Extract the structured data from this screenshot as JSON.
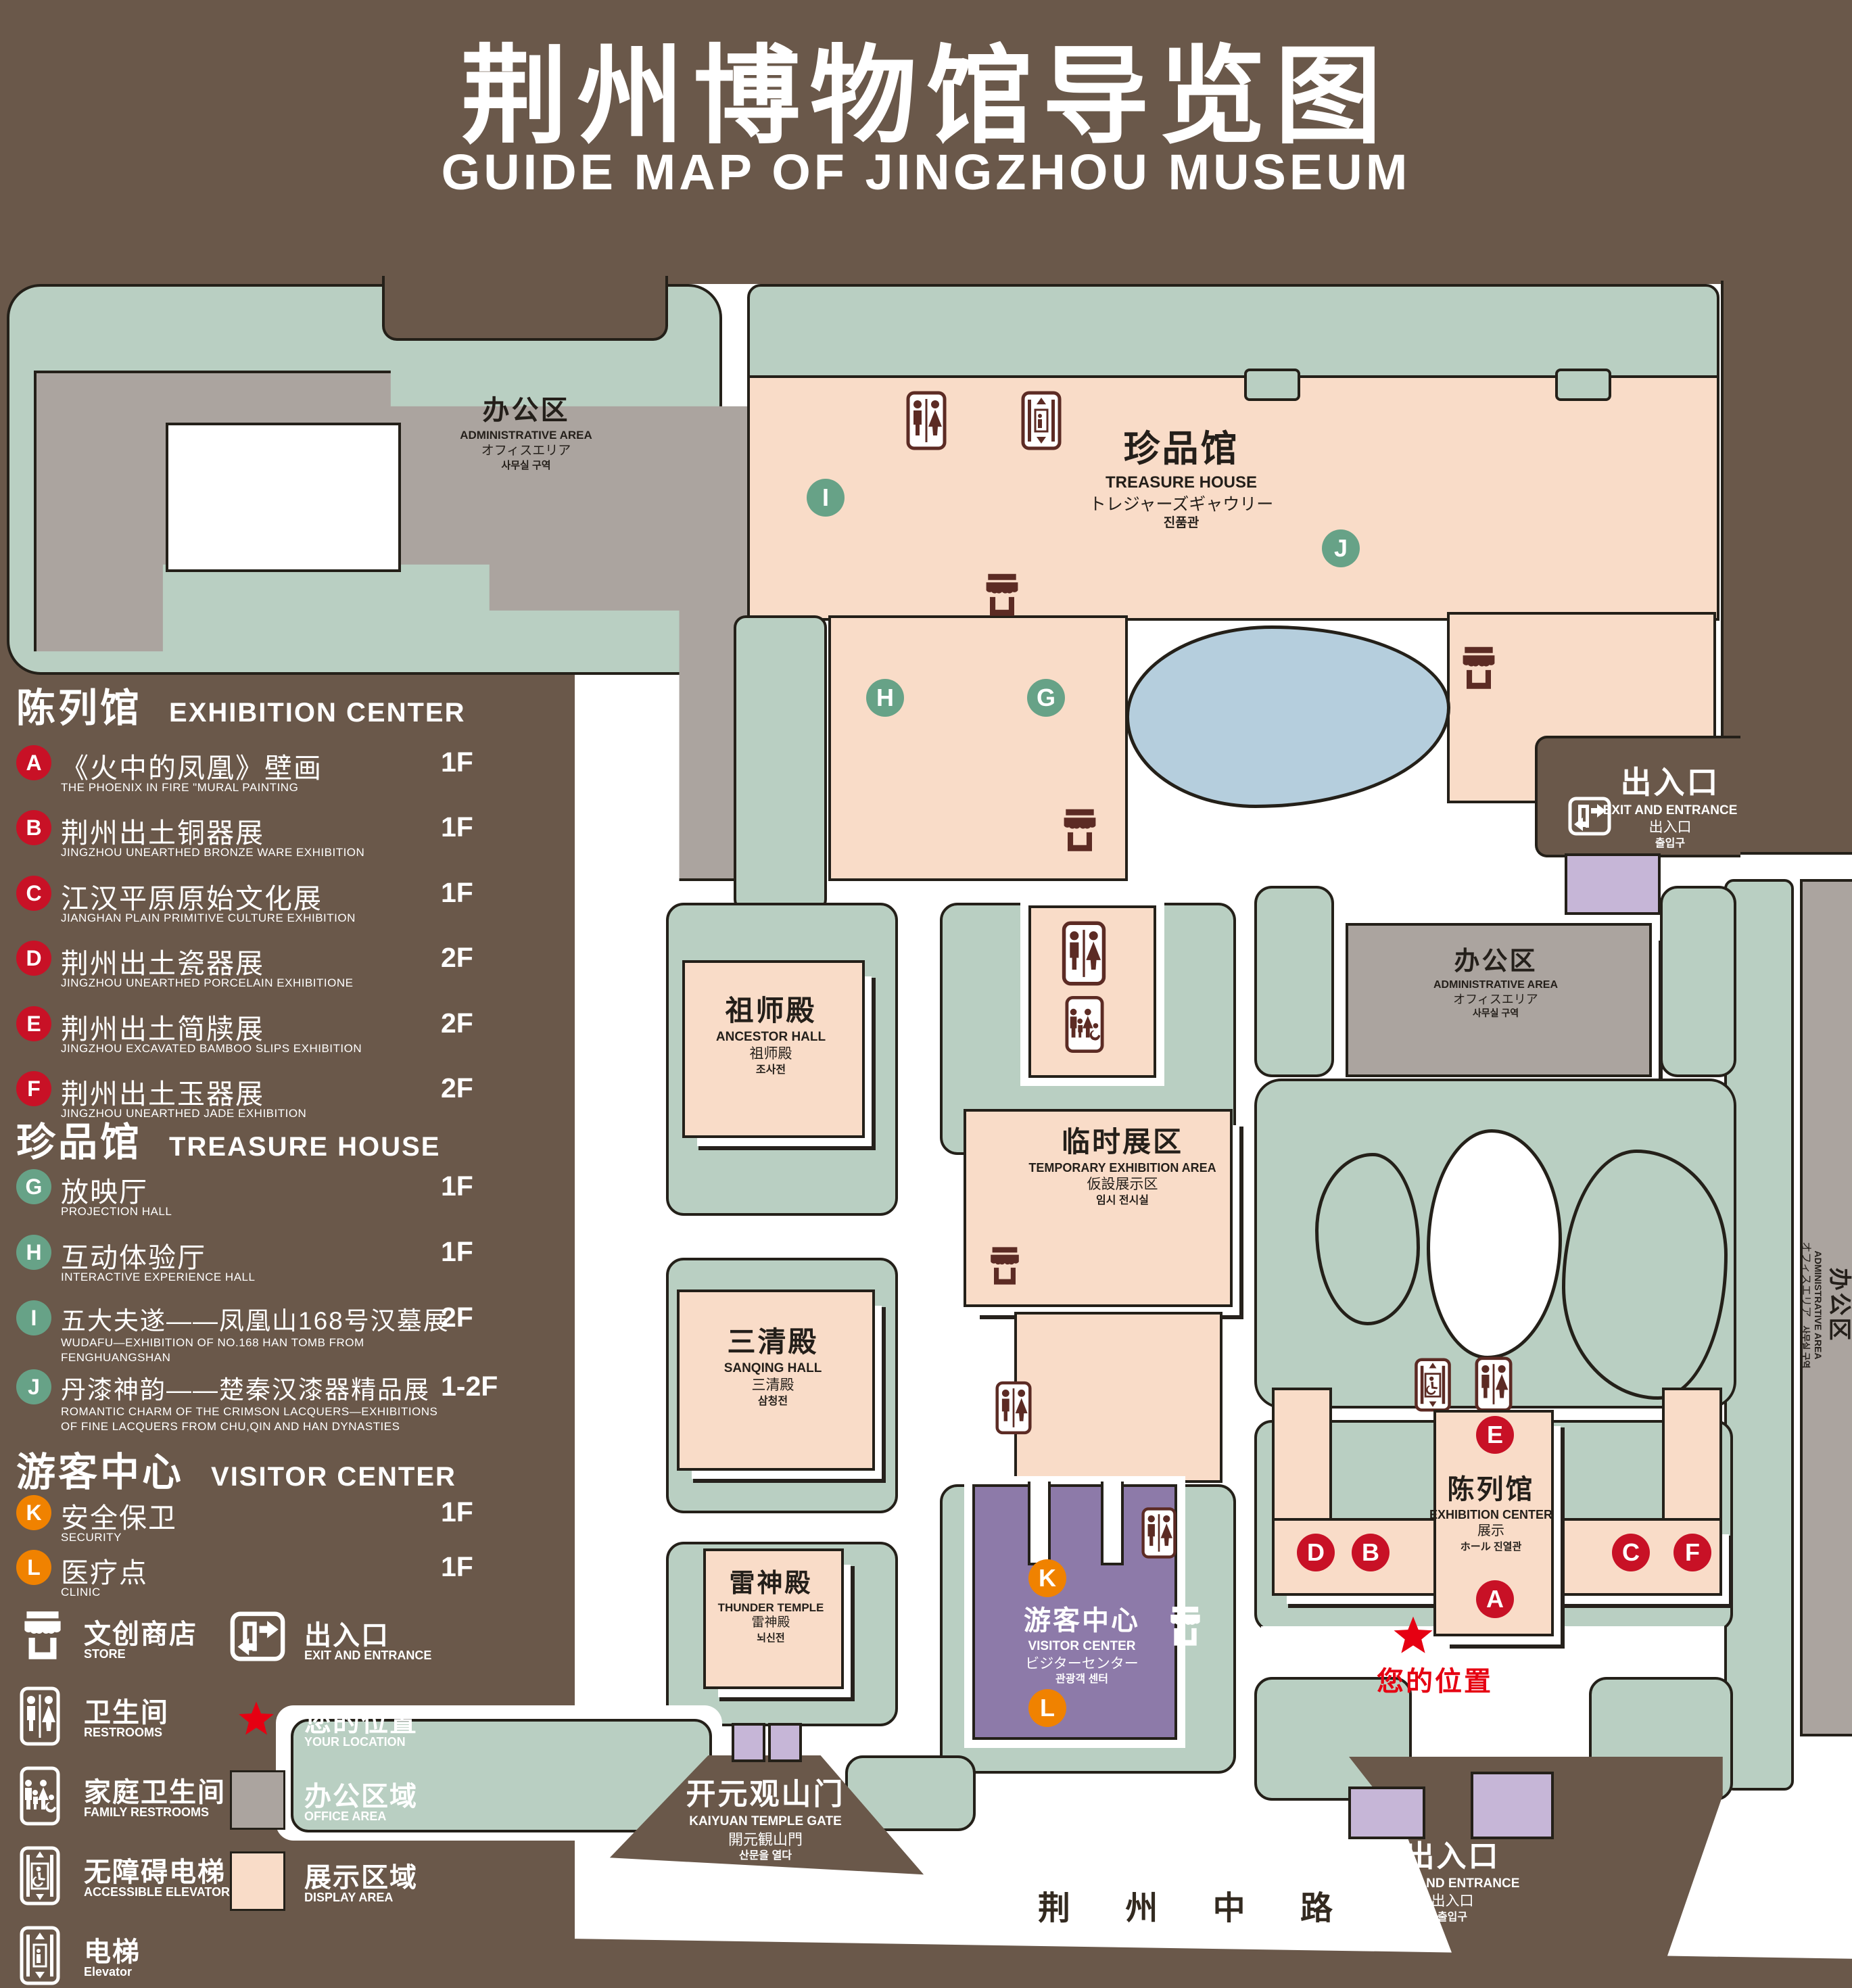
{
  "title": {
    "cn": "荆州博物馆导览图",
    "en": "GUIDE MAP OF JINGZHOU MUSEUM"
  },
  "legend": {
    "sections": [
      {
        "cn": "陈列馆",
        "en": "EXHIBITION CENTER",
        "items": [
          {
            "letter": "A",
            "cn": "《火中的凤凰》壁画",
            "en": "THE PHOENIX IN FIRE \"MURAL PAINTING",
            "floor": "1F"
          },
          {
            "letter": "B",
            "cn": "荆州出土铜器展",
            "en": "JINGZHOU UNEARTHED BRONZE WARE EXHIBITION",
            "floor": "1F"
          },
          {
            "letter": "C",
            "cn": "江汉平原原始文化展",
            "en": "JIANGHAN PLAIN PRIMITIVE CULTURE EXHIBITION",
            "floor": "1F"
          },
          {
            "letter": "D",
            "cn": "荆州出土瓷器展",
            "en": "JINGZHOU UNEARTHED PORCELAIN EXHIBITIONE",
            "floor": "2F"
          },
          {
            "letter": "E",
            "cn": "荆州出土简牍展",
            "en": "JINGZHOU EXCAVATED BAMBOO SLIPS EXHIBITION",
            "floor": "2F"
          },
          {
            "letter": "F",
            "cn": "荆州出土玉器展",
            "en": "JINGZHOU UNEARTHED JADE EXHIBITION",
            "floor": "2F"
          }
        ]
      },
      {
        "cn": "珍品馆",
        "en": "TREASURE HOUSE",
        "items": [
          {
            "letter": "G",
            "cn": "放映厅",
            "en": "PROJECTION HALL",
            "floor": "1F"
          },
          {
            "letter": "H",
            "cn": "互动体验厅",
            "en": "INTERACTIVE EXPERIENCE HALL",
            "floor": "1F"
          },
          {
            "letter": "I",
            "cn": "五大夫遂——凤凰山168号汉墓展",
            "en": "WUDAFU—EXHIBITION OF NO.168 HAN TOMB FROM FENGHUANGSHAN",
            "floor": "2F"
          },
          {
            "letter": "J",
            "cn": "丹漆神韵——楚秦汉漆器精品展",
            "en": "ROMANTIC CHARM OF THE CRIMSON LACQUERS—EXHIBITIONS OF FINE LACQUERS FROM CHU,QIN AND HAN DYNASTIES",
            "floor": "1-2F"
          }
        ]
      },
      {
        "cn": "游客中心",
        "en": "VISITOR CENTER",
        "items": [
          {
            "letter": "K",
            "cn": "安全保卫",
            "en": "SECURITY",
            "floor": "1F"
          },
          {
            "letter": "L",
            "cn": "医疗点",
            "en": "CLINIC",
            "floor": "1F"
          }
        ]
      }
    ],
    "symbols": {
      "store": {
        "cn": "文创商店",
        "en": "STORE"
      },
      "restrooms": {
        "cn": "卫生间",
        "en": "RESTROOMS"
      },
      "family_restrooms": {
        "cn": "家庭卫生间",
        "en": "FAMILY RESTROOMS"
      },
      "accessible_elevator": {
        "cn": "无障碍电梯",
        "en": "ACCESSIBLE ELEVATOR"
      },
      "elevator": {
        "cn": "电梯",
        "en": "Elevator"
      },
      "exit": {
        "cn": "出入口",
        "en": "EXIT AND ENTRANCE"
      },
      "your_location": {
        "cn": "您的位置",
        "en": "YOUR LOCATION"
      },
      "office_area": {
        "cn": "办公区域",
        "en": "OFFICE AREA"
      },
      "display_area": {
        "cn": "展示区域",
        "en": "DISPLAY AREA"
      }
    }
  },
  "map": {
    "buildings": {
      "admin_tl": {
        "cn": "办公区",
        "en": "ADMINISTRATIVE AREA",
        "jp": "オフィスエリア",
        "kr": "사무실 구역"
      },
      "treasure_house": {
        "cn": "珍品馆",
        "en": "TREASURE HOUSE",
        "jp": "トレジャーズギャウリー",
        "kr": "진품관"
      },
      "admin_right": {
        "cn": "办公区",
        "en": "ADMINISTRATIVE AREA",
        "jp": "オフィスエリア",
        "kr": "사무실 구역"
      },
      "admin_strip": {
        "cn": "办公区",
        "en": "ADMINISTRATIVE AREA",
        "jp": "オフィスエリア",
        "kr": "사무실 구역"
      },
      "ancestor_hall": {
        "cn": "祖师殿",
        "en": "ANCESTOR HALL",
        "jp": "祖师殿",
        "kr": "조사전"
      },
      "temp_exhibition": {
        "cn": "临时展区",
        "en": "TEMPORARY EXHIBITION AREA",
        "jp": "仮設展示区",
        "kr": "임시 전시실"
      },
      "sanqing_hall": {
        "cn": "三清殿",
        "en": "SANQING HALL",
        "jp": "三清殿",
        "kr": "삼청전"
      },
      "thunder_temple": {
        "cn": "雷神殿",
        "en": "THUNDER TEMPLE",
        "jp": "雷神殿",
        "kr": "뇌신전"
      },
      "visitor_center": {
        "cn": "游客中心",
        "en": "VISITOR CENTER",
        "jp": "ビジターセンター",
        "kr": "관광객 센터"
      },
      "exhibition_center": {
        "cn": "陈列馆",
        "en": "EXHIBITION CENTER",
        "jp": "展示",
        "kr": "ホール 진열관"
      },
      "kaiyuan_gate": {
        "cn": "开元观山门",
        "en": "KAIYUAN TEMPLE GATE",
        "jp": "開元観山門",
        "kr": "산문을 열다"
      }
    },
    "labels": {
      "exit_top": {
        "cn": "出入口",
        "en": "EXIT AND ENTRANCE",
        "jp": "出入口",
        "kr": "출입구"
      },
      "exit_bottom": {
        "cn": "出入口",
        "en": "EXIT AND ENTRANCE",
        "jp": "出入口",
        "kr": "출입구"
      },
      "road": "荆 州 中 路",
      "your_location": "您的位置"
    },
    "markers": {
      "A": "A",
      "B": "B",
      "C": "C",
      "D": "D",
      "E": "E",
      "F": "F",
      "G": "G",
      "H": "H",
      "I": "I",
      "J": "J",
      "K": "K",
      "L": "L"
    }
  },
  "colors": {
    "background": "#6a584a",
    "lawn": "#b9cfc2",
    "display_area": "#f9dcc8",
    "office_area": "#aba49f",
    "visitor_center": "#8d7aa9",
    "gate_purple": "#c6b6d7",
    "lake": "#b5cedd",
    "marker_red": "#c81126",
    "marker_green": "#67a287",
    "marker_orange": "#f08200",
    "location_red": "#e60012",
    "icon_brown": "#5c2b24"
  }
}
